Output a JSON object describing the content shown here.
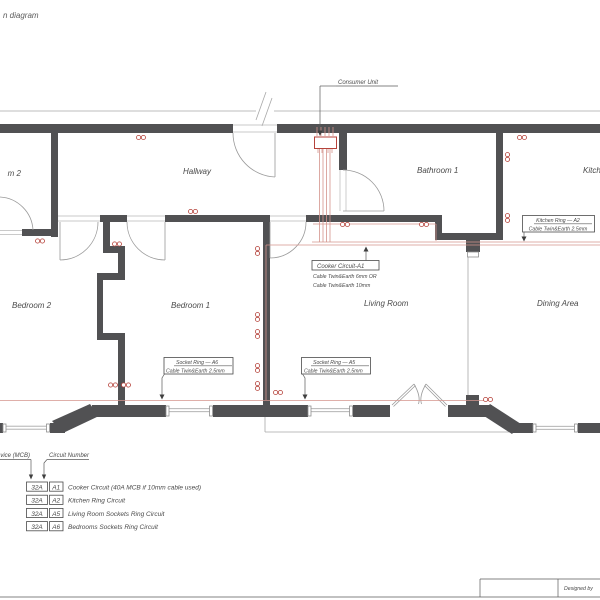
{
  "title": "n diagram",
  "drawing": {
    "consumer_unit_label": "Consumer Unit",
    "rooms": {
      "room2_partial": "m 2",
      "hallway": "Hallway",
      "bathroom1": "Bathroom 1",
      "kitchen": "Kitchen",
      "bedroom2": "Bedroom 2",
      "bedroom1": "Bedroom 1",
      "living_room": "Living Room",
      "dining_area": "Dining Area"
    },
    "callouts": {
      "kitchen_ring": {
        "title": "Kitchen Ring — A2",
        "cable": "Cable Twin&Earth 2.5mm"
      },
      "cooker": {
        "title": "Cooker Circuit-A1",
        "cable1": "Cable Twin&Earth 6mm OR",
        "cable2": "Cable Twin&Earth 10mm"
      },
      "socket_a6": {
        "title": "Socket Ring — A6",
        "cable": "Cable Twin&Earth 2.5mm"
      },
      "socket_a5": {
        "title": "Socket Ring — A5",
        "cable": "Cable Twin&Earth 2.5mm"
      }
    }
  },
  "legend": {
    "protective_device_label": "device (MCB)",
    "circuit_number_label": "Circuit Number",
    "rows": [
      {
        "mcb": "32A",
        "circuit": "A1",
        "desc": "Cooker Circuit (40A MCB if 10mm cable used)"
      },
      {
        "mcb": "32A",
        "circuit": "A2",
        "desc": "Kitchen Ring Circuit"
      },
      {
        "mcb": "32A",
        "circuit": "A5",
        "desc": "Living Room Sockets Ring Circuit"
      },
      {
        "mcb": "32A",
        "circuit": "A6",
        "desc": "Bedrooms Sockets Ring Circuit"
      }
    ]
  },
  "title_block": {
    "designed_by": "Designed by"
  },
  "colors": {
    "wall": "#515153",
    "thin_line": "#a8a8a8",
    "text": "#4a4a4a",
    "cable_red": "#d4948c",
    "symbol_red": "#b5423a"
  }
}
